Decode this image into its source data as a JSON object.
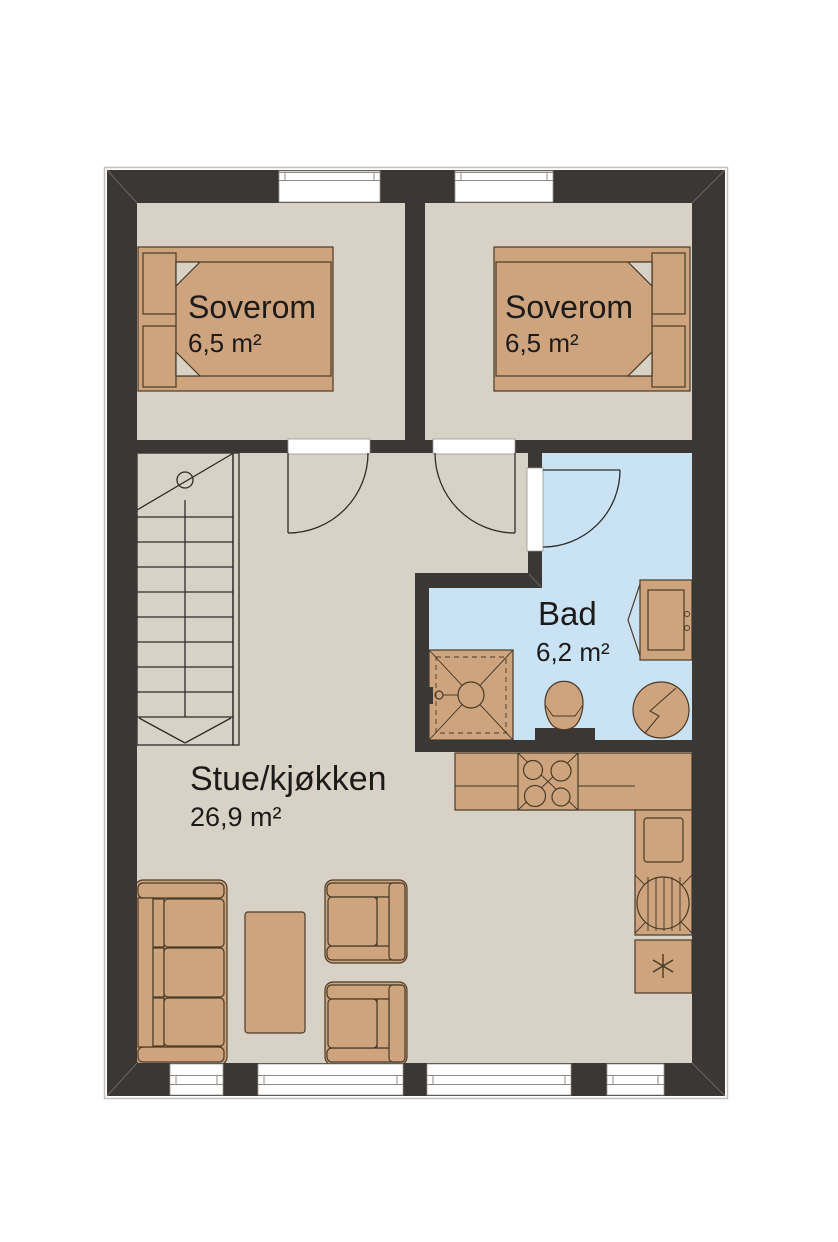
{
  "colors": {
    "wall": "#3a3734",
    "floor": "#d8d2c6",
    "bath_floor": "#c9e3f5",
    "furniture": "#cda47e",
    "furniture_stroke": "#4a3a26",
    "line": "#2e2b28",
    "text": "#1d1b19",
    "window_frame": "#8d8a86"
  },
  "rooms": [
    {
      "name": "Soverom",
      "area": "6,5 m²"
    },
    {
      "name": "Soverom",
      "area": "6,5 m²"
    },
    {
      "name": "Bad",
      "area": "6,2 m²"
    },
    {
      "name": "Stue/kjøkken",
      "area": "26,9 m²"
    }
  ],
  "fixtures": {
    "bedroom_1": [
      "double-bed"
    ],
    "bedroom_2": [
      "double-bed"
    ],
    "bathroom": [
      "shower",
      "toilet",
      "washing-machine",
      "vanity-sink"
    ],
    "kitchen": [
      "stove-4-burners",
      "kitchen-sink",
      "refrigerator-freezer-star"
    ],
    "living_room": [
      "sofa-3-seat",
      "coffee-table",
      "armchair",
      "armchair"
    ],
    "circulation": [
      "staircase",
      "door-swing",
      "door-swing",
      "door-swing"
    ],
    "windows": {
      "top_wall": 2,
      "bottom_wall": 4
    }
  }
}
